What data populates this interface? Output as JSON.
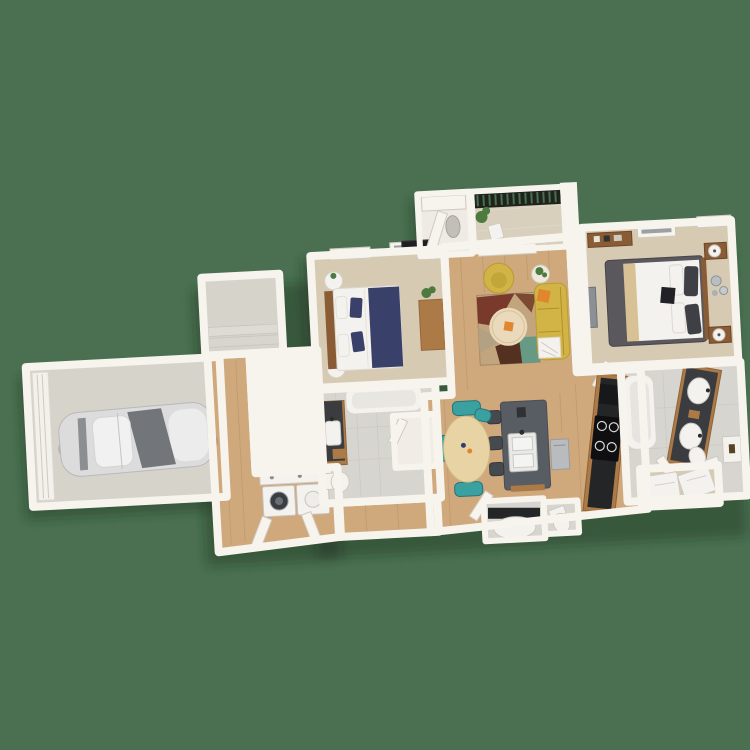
{
  "scene": {
    "kind": "3d-aerial-floorplan-render",
    "view": "top-down dollhouse",
    "background_note": "solid green backdrop, no visible text"
  },
  "colors": {
    "background": "#4a7051",
    "wall": "#f7f4ee",
    "carpet": "#d7cab3",
    "wood": "#cfa87c",
    "tile": "#d7d5cf",
    "concrete": "#d6d3cb",
    "balconyFloor": "#d8cfbc",
    "whiteApp": "#f4f2ee",
    "cabinetWood": "#ab7a47",
    "furnWood": "#8a5c36",
    "counterDark": "#232527",
    "island": "#585d63",
    "railing": "#1e231c",
    "sofa": "#d2b446",
    "orange": "#e0862e",
    "navy": "#39406a",
    "charcoal": "#5a585c",
    "tan": "#d9c196",
    "tealChair": "#3aa0a0",
    "rugMaroon": "#7a3a2b",
    "rugBrown": "#7c4a30",
    "rugTan": "#c2a57e",
    "rugCream": "#ead9b8",
    "rugTeal": "#679a84",
    "rugDark": "#53301f",
    "plant": "#4c7a3f",
    "carBody": "#dcdcdc",
    "carGlass": "#72767a",
    "shadow": "rgba(25,45,30,0.38)"
  },
  "rooms": [
    {
      "id": "garage",
      "contents": [
        "car",
        "garage-door"
      ]
    },
    {
      "id": "entry-landing",
      "contents": [
        "steps"
      ]
    },
    {
      "id": "hallway",
      "contents": [
        "laundry-counter",
        "washer",
        "dryer",
        "bifold-doors"
      ]
    },
    {
      "id": "bedroom-1",
      "contents": [
        "bed-navy",
        "nightstand-lamp-x2",
        "desk",
        "plant",
        "tv",
        "windows-x2"
      ]
    },
    {
      "id": "bathroom-1",
      "contents": [
        "vanity",
        "toilet",
        "tub"
      ]
    },
    {
      "id": "living-room",
      "contents": [
        "yellow-sofa",
        "yellow-armchair",
        "geometric-rug",
        "round-coffee-table",
        "side-table-plant",
        "wall-tv"
      ]
    },
    {
      "id": "balcony",
      "contents": [
        "metal-railing",
        "patio-chair",
        "plant"
      ]
    },
    {
      "id": "utility-closet",
      "contents": [
        "shelf",
        "open-door",
        "water-heater"
      ]
    },
    {
      "id": "bedroom-2",
      "contents": [
        "bed-charcoal",
        "nightstand-lamp-x2",
        "dresser",
        "wall-art-circles",
        "windows-x2"
      ]
    },
    {
      "id": "kitchen",
      "contents": [
        "island-with-sink",
        "stools-x3",
        "dishwasher",
        "counter-run",
        "stove"
      ]
    },
    {
      "id": "dining",
      "contents": [
        "oval-table",
        "teal-chairs-x4"
      ]
    },
    {
      "id": "powder-room",
      "contents": [
        "dark-counter",
        "basin",
        "toilet"
      ]
    },
    {
      "id": "bathroom-2",
      "contents": [
        "double-vanity",
        "tub",
        "toilet",
        "cabinet"
      ]
    },
    {
      "id": "walk-in-closet",
      "contents": [
        "shelving-units"
      ]
    }
  ]
}
